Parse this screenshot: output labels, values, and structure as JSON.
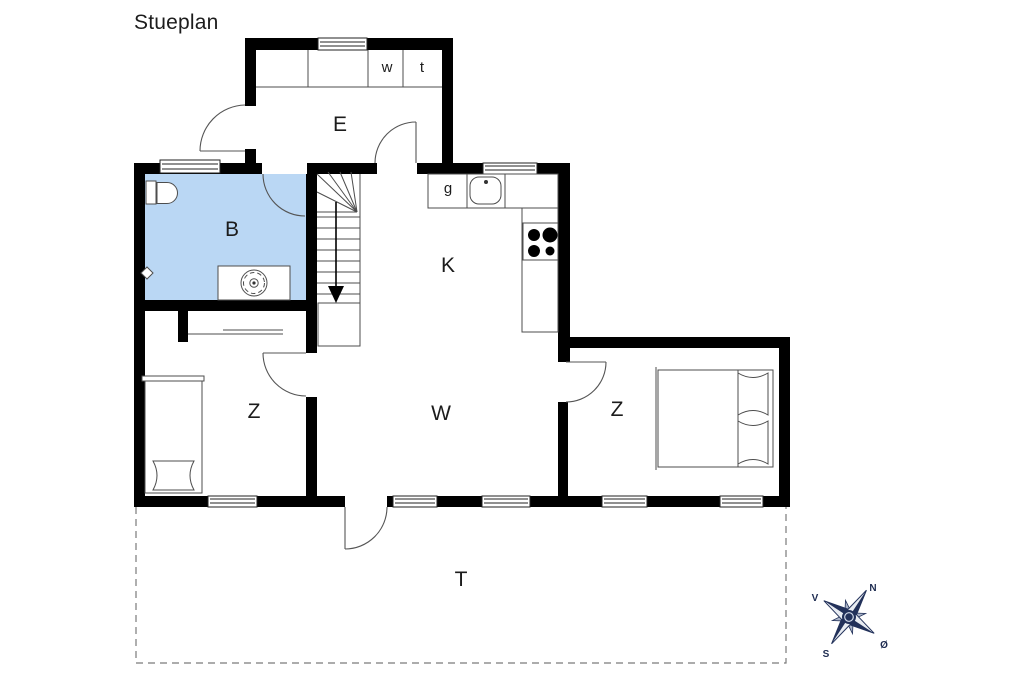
{
  "title": "Stueplan",
  "colors": {
    "wall": "#000000",
    "bathroom_fill": "#bad7f4",
    "compass_navy": "#22315a",
    "dashed_outline": "#7a7a7a"
  },
  "rooms": {
    "entrance_hall": {
      "label": "E"
    },
    "bathroom": {
      "label": "B"
    },
    "kitchen": {
      "label": "K"
    },
    "living_room": {
      "label": "W"
    },
    "bedroom_left": {
      "label": "Z"
    },
    "bedroom_right": {
      "label": "Z"
    },
    "terrace": {
      "label": "T"
    }
  },
  "fixtures": {
    "washer": "w",
    "dryer": "t",
    "fridge": "g"
  },
  "compass": {
    "north": "N",
    "west": "V",
    "south": "S",
    "east": "Ø"
  }
}
